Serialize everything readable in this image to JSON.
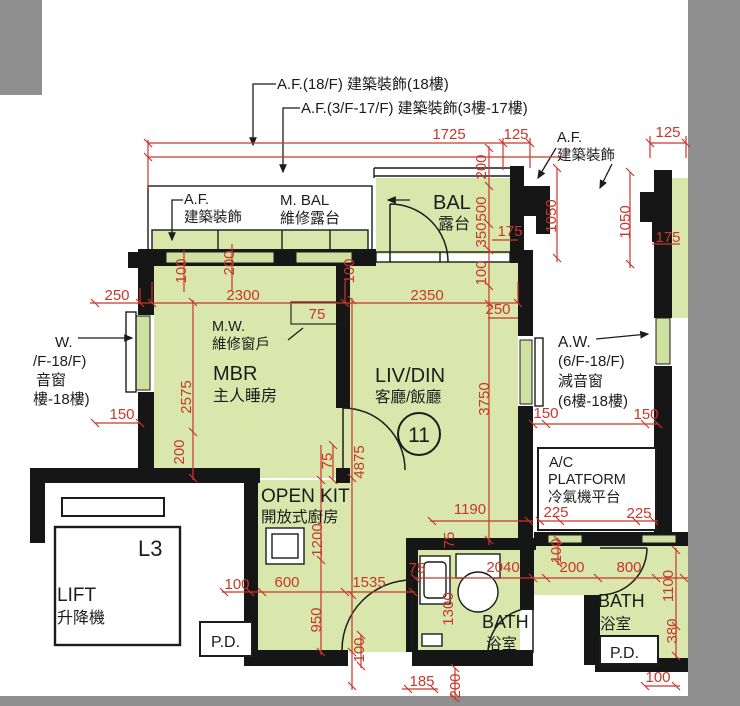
{
  "colors": {
    "room_green": "#d9e6ac",
    "glass_green": "#cfe1a0",
    "wall_black": "#161616",
    "dim_red": "#c8372b",
    "frame_gray": "#8f8f8f",
    "paper": "#ffffff"
  },
  "labels": {
    "af_18f": "A.F.(18/F) 建築裝飾(18樓)",
    "af_3f_17f": "A.F.(3/F-17/F) 建築裝飾(3樓-17樓)",
    "af_short_1": "A.F.",
    "af_short_2": "建築裝飾",
    "m_bal_1": "M. BAL",
    "m_bal_2": "維修露台",
    "bal_1": "BAL",
    "bal_2": "露台",
    "mw_1": "M.W.",
    "mw_2": "維修窗戶",
    "mbr_1": "MBR",
    "mbr_2": "主人睡房",
    "livdin_1": "LIV/DIN",
    "livdin_2": "客廳/飯廳",
    "unit_number": "11",
    "aw_left": [
      "W.",
      "/F-18/F)",
      "音窗",
      "樓-18樓)"
    ],
    "aw_right": [
      "A.W.",
      "(6/F-18/F)",
      "減音窗",
      "(6樓-18樓)"
    ],
    "ac_1": "A/C",
    "ac_2": "PLATFORM",
    "ac_3": "冷氣機平台",
    "open_kit_1": "OPEN KIT",
    "open_kit_2": "開放式廚房",
    "lobby": "L3",
    "lift_1": "LIFT",
    "lift_2": "升降機",
    "pd": "P.D.",
    "bath_en": "BATH",
    "bath_zh": "浴室"
  },
  "dims": [
    "1725",
    "125",
    "125",
    "250",
    "2300",
    "2350",
    "250",
    "75",
    "150",
    "150",
    "150",
    "225",
    "225",
    "1190",
    "2040",
    "200",
    "800",
    "100",
    "600",
    "1535",
    "75",
    "185",
    "200",
    "100",
    "175",
    "175",
    "1050",
    "1050",
    "200",
    "500",
    "350",
    "100",
    "100",
    "200",
    "100",
    "2575",
    "200",
    "3750",
    "4875",
    "75",
    "1200",
    "950",
    "75",
    "1300",
    "100",
    "100",
    "1100",
    "380"
  ]
}
